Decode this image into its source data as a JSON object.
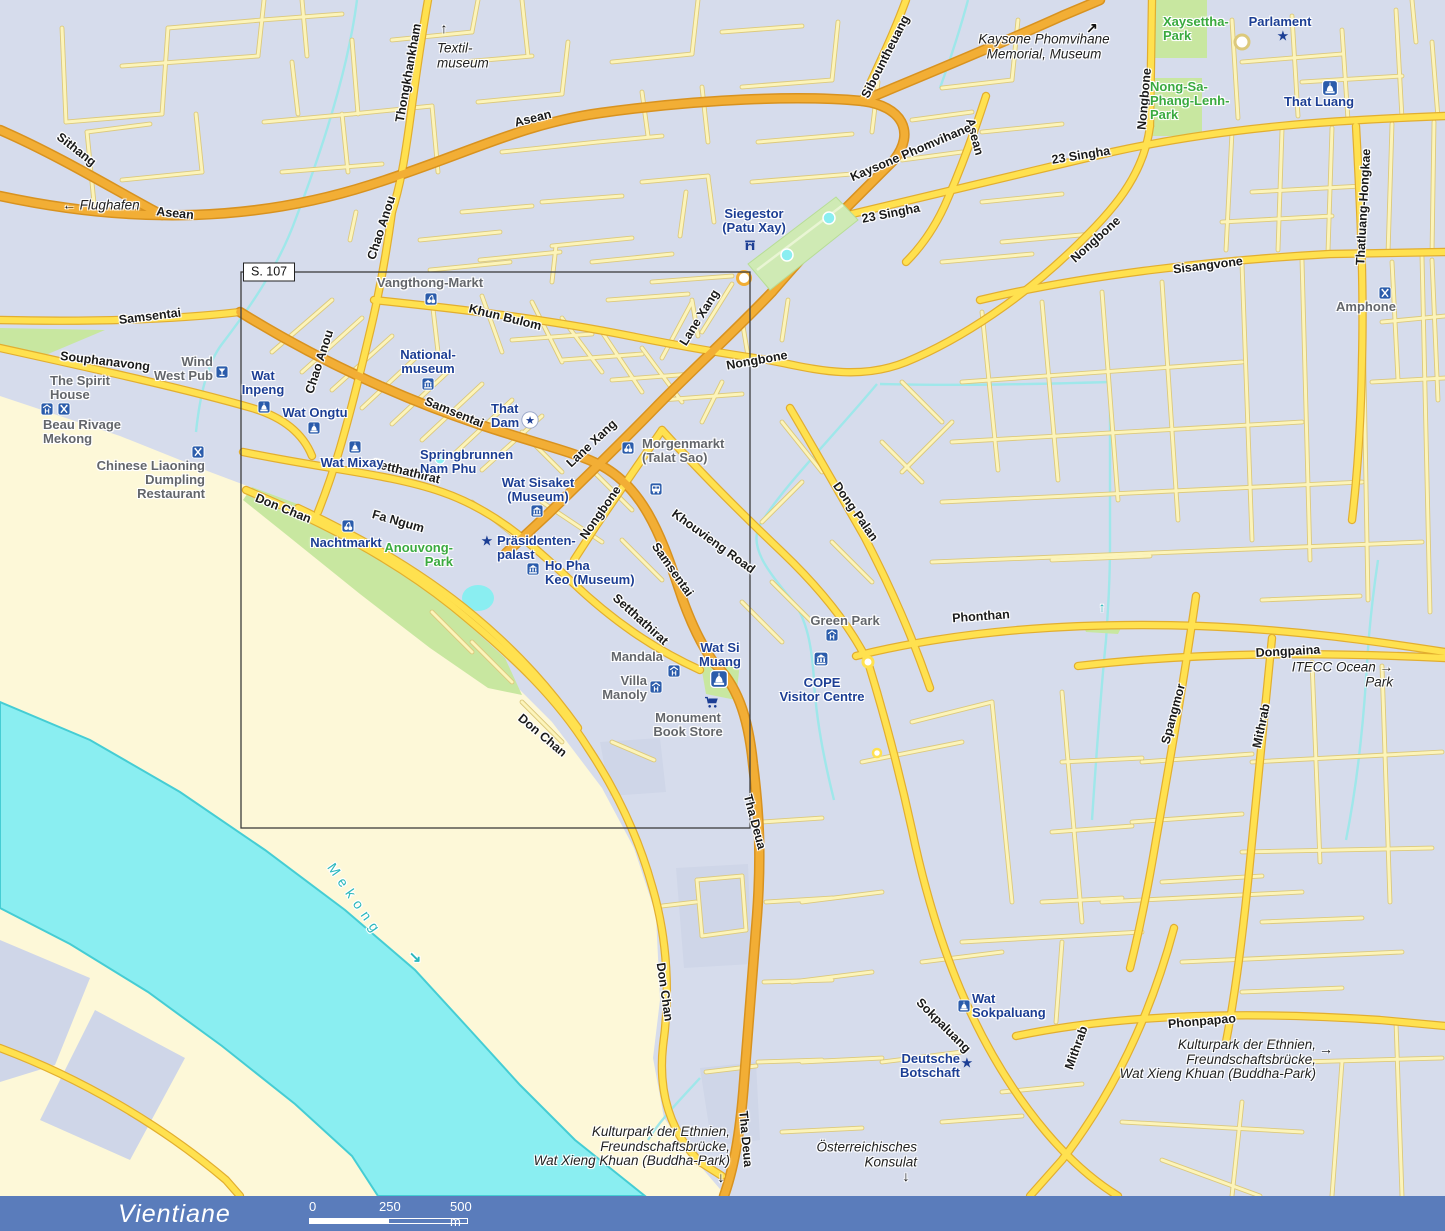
{
  "colors": {
    "background": "#d6dcec",
    "land": "#fdf8d8",
    "river": "#8aeef1",
    "river_edge": "#45cdd4",
    "park": "#c8e7a0",
    "road_minor": "#fcf4ba",
    "road_main": "#ffe14f",
    "road_highway": "#f2ae35",
    "poi_text": "#1c3e94",
    "poi_gray": "#63666b",
    "park_text": "#3aaa3f",
    "water_text": "#29b7bc",
    "icon_blue": "#2b5cab",
    "footer_bar": "#5a7cbb"
  },
  "map": {
    "region_label": "S. 107",
    "labels": [
      {
        "t": "Sithang",
        "x": 76,
        "y": 150,
        "r": 38,
        "s": "road"
      },
      {
        "t": "Asean",
        "x": 175,
        "y": 214,
        "r": 6,
        "s": "road"
      },
      {
        "t": "Asean",
        "x": 533,
        "y": 119,
        "r": -14,
        "s": "road"
      },
      {
        "t": "Asean",
        "x": 974,
        "y": 137,
        "r": 75,
        "s": "road"
      },
      {
        "t": "Thongkhankham",
        "x": 409,
        "y": 73,
        "r": -80,
        "s": "road"
      },
      {
        "t": "Chao Anou",
        "x": 382,
        "y": 228,
        "r": -72,
        "s": "road"
      },
      {
        "t": "Chao Anou",
        "x": 320,
        "y": 362,
        "r": -72,
        "s": "road"
      },
      {
        "t": "Sibountheuang",
        "x": 886,
        "y": 57,
        "r": -63,
        "s": "road"
      },
      {
        "t": "Kaysone Phomvihane",
        "x": 911,
        "y": 153,
        "r": -23,
        "s": "road"
      },
      {
        "t": "23 Singha",
        "x": 891,
        "y": 214,
        "r": -11,
        "s": "road"
      },
      {
        "t": "23 Singha",
        "x": 1081,
        "y": 156,
        "r": -9,
        "s": "road"
      },
      {
        "t": "Nongbone",
        "x": 1145,
        "y": 99,
        "r": -85,
        "s": "road"
      },
      {
        "t": "Nongbone",
        "x": 1096,
        "y": 240,
        "r": -42,
        "s": "road"
      },
      {
        "t": "Nongbone",
        "x": 757,
        "y": 361,
        "r": -10,
        "s": "road"
      },
      {
        "t": "Nongbone",
        "x": 601,
        "y": 513,
        "r": -55,
        "s": "road"
      },
      {
        "t": "Sisangvone",
        "x": 1208,
        "y": 266,
        "r": -7,
        "s": "road"
      },
      {
        "t": "Thatluang-Hongkae",
        "x": 1364,
        "y": 207,
        "r": -87,
        "s": "road"
      },
      {
        "t": "Samsentai",
        "x": 150,
        "y": 317,
        "r": -7,
        "s": "road"
      },
      {
        "t": "Samsentai",
        "x": 454,
        "y": 413,
        "r": 22,
        "s": "road"
      },
      {
        "t": "Samsentai",
        "x": 672,
        "y": 570,
        "r": 55,
        "s": "road"
      },
      {
        "t": "Souphanavong",
        "x": 105,
        "y": 362,
        "r": 7,
        "s": "road"
      },
      {
        "t": "Khun Bulom",
        "x": 505,
        "y": 318,
        "r": 14,
        "s": "road"
      },
      {
        "t": "Lane Xang",
        "x": 700,
        "y": 318,
        "r": -58,
        "s": "road"
      },
      {
        "t": "Lane Xang",
        "x": 592,
        "y": 444,
        "r": -43,
        "s": "road"
      },
      {
        "t": "Setthathirat",
        "x": 406,
        "y": 472,
        "r": 14,
        "s": "road"
      },
      {
        "t": "Setthathirat",
        "x": 640,
        "y": 620,
        "r": 42,
        "s": "road"
      },
      {
        "t": "Khouvieng Road",
        "x": 713,
        "y": 542,
        "r": 36,
        "s": "road"
      },
      {
        "t": "Fa Ngum",
        "x": 398,
        "y": 522,
        "r": 16,
        "s": "road"
      },
      {
        "t": "Don Chan",
        "x": 283,
        "y": 509,
        "r": 22,
        "s": "road"
      },
      {
        "t": "Don Chan",
        "x": 542,
        "y": 736,
        "r": 40,
        "s": "road"
      },
      {
        "t": "Don Chan",
        "x": 664,
        "y": 992,
        "r": 82,
        "s": "road"
      },
      {
        "t": "Tha Deua",
        "x": 754,
        "y": 822,
        "r": 75,
        "s": "road"
      },
      {
        "t": "Tha Deua",
        "x": 745,
        "y": 1139,
        "r": 85,
        "s": "road"
      },
      {
        "t": "Dong Palan",
        "x": 855,
        "y": 512,
        "r": 55,
        "s": "road"
      },
      {
        "t": "Phonthan",
        "x": 981,
        "y": 617,
        "r": -4,
        "s": "road"
      },
      {
        "t": "Dongpaina",
        "x": 1288,
        "y": 652,
        "r": -3,
        "s": "road"
      },
      {
        "t": "Spangmor",
        "x": 1174,
        "y": 714,
        "r": -75,
        "s": "road"
      },
      {
        "t": "Mithrab",
        "x": 1262,
        "y": 726,
        "r": -78,
        "s": "road"
      },
      {
        "t": "Mithrab",
        "x": 1077,
        "y": 1048,
        "r": -70,
        "s": "road"
      },
      {
        "t": "Sokpaluang",
        "x": 943,
        "y": 1026,
        "r": 45,
        "s": "road"
      },
      {
        "t": "Phonpapao",
        "x": 1202,
        "y": 1022,
        "r": -5,
        "s": "road"
      },
      {
        "t": "Siegestor\n(Patu Xay)",
        "x": 754,
        "y": 221,
        "s": "poi"
      },
      {
        "t": "Parlament",
        "x": 1280,
        "y": 22,
        "s": "poi"
      },
      {
        "t": "That Luang",
        "x": 1319,
        "y": 102,
        "s": "poi"
      },
      {
        "t": "Wat\nInpeng",
        "x": 263,
        "y": 383,
        "s": "poi"
      },
      {
        "t": "Wat Ongtu",
        "x": 315,
        "y": 413,
        "s": "poi"
      },
      {
        "t": "Wat Mixay",
        "x": 352,
        "y": 463,
        "s": "poi"
      },
      {
        "t": "National-\nmuseum",
        "x": 428,
        "y": 362,
        "s": "poi"
      },
      {
        "t": "That\nDam",
        "x": 491,
        "y": 416,
        "a": "l",
        "s": "poi"
      },
      {
        "t": "Springbrunnen\nNam Phu",
        "x": 420,
        "y": 462,
        "a": "l",
        "s": "poi"
      },
      {
        "t": "Wat Sisaket\n(Museum)",
        "x": 538,
        "y": 490,
        "s": "poi"
      },
      {
        "t": "Präsidenten-\npalast",
        "x": 497,
        "y": 548,
        "a": "l",
        "s": "poi"
      },
      {
        "t": "Ho Pha\nKeo (Museum)",
        "x": 545,
        "y": 573,
        "a": "l",
        "s": "poi"
      },
      {
        "t": "Wat Si\nMuang",
        "x": 720,
        "y": 655,
        "s": "poi"
      },
      {
        "t": "COPE\nVisitor Centre",
        "x": 822,
        "y": 690,
        "s": "poi"
      },
      {
        "t": "Wat\nSokpaluang",
        "x": 972,
        "y": 1006,
        "a": "l",
        "s": "poi"
      },
      {
        "t": "Deutsche\nBotschaft",
        "x": 960,
        "y": 1066,
        "a": "r",
        "s": "poi"
      },
      {
        "t": "Nachtmarkt",
        "x": 346,
        "y": 543,
        "s": "poi"
      },
      {
        "t": "Wind\nWest Pub",
        "x": 213,
        "y": 369,
        "a": "r",
        "s": "gray"
      },
      {
        "t": "Vangthong-Markt",
        "x": 430,
        "y": 283,
        "s": "gray"
      },
      {
        "t": "Morgenmarkt\n(Talat Sao)",
        "x": 642,
        "y": 451,
        "a": "l",
        "s": "gray"
      },
      {
        "t": "The Spirit\nHouse",
        "x": 50,
        "y": 388,
        "a": "l",
        "s": "gray"
      },
      {
        "t": "Beau Rivage\nMekong",
        "x": 43,
        "y": 432,
        "a": "l",
        "s": "gray"
      },
      {
        "t": "Chinese Liaoning\nDumpling\nRestaurant",
        "x": 205,
        "y": 480,
        "a": "r",
        "s": "gray"
      },
      {
        "t": "Green Park",
        "x": 845,
        "y": 621,
        "s": "gray"
      },
      {
        "t": "Mandala",
        "x": 637,
        "y": 657,
        "s": "gray"
      },
      {
        "t": "Villa\nManoly",
        "x": 647,
        "y": 688,
        "a": "r",
        "s": "gray"
      },
      {
        "t": "Monument\nBook Store",
        "x": 688,
        "y": 725,
        "s": "gray"
      },
      {
        "t": "Amphone",
        "x": 1366,
        "y": 307,
        "s": "gray"
      },
      {
        "t": "← Flughafen",
        "x": 101,
        "y": 206,
        "s": "it"
      },
      {
        "t": "Textil-\nmuseum",
        "x": 437,
        "y": 56,
        "a": "l",
        "s": "it"
      },
      {
        "t": "Kaysone Phomvihane\nMemorial, Museum",
        "x": 1044,
        "y": 47,
        "s": "it"
      },
      {
        "t": "ITECC Ocean →\nPark",
        "x": 1393,
        "y": 675,
        "a": "r",
        "s": "it"
      },
      {
        "t": "Kulturpark der Ethnien,\nFreundschaftsbrücke,\nWat Xieng Khuan (Buddha-Park)",
        "x": 1316,
        "y": 1060,
        "a": "r",
        "s": "it"
      },
      {
        "t": "Kulturpark der Ethnien,\nFreundschaftsbrücke,\nWat Xieng Khuan (Buddha-Park)",
        "x": 730,
        "y": 1147,
        "a": "r",
        "s": "it"
      },
      {
        "t": "Österreichisches\nKonsulat",
        "x": 917,
        "y": 1155,
        "a": "r",
        "s": "it"
      },
      {
        "t": "Xaysettha-\nPark",
        "x": 1163,
        "y": 29,
        "a": "l",
        "s": "park"
      },
      {
        "t": "Nong-Sa-\nPhang-Lenh-\nPark",
        "x": 1150,
        "y": 101,
        "a": "l",
        "s": "park"
      },
      {
        "t": "Anouvong-\nPark",
        "x": 453,
        "y": 555,
        "a": "r",
        "s": "park"
      },
      {
        "t": "Mekong",
        "x": 355,
        "y": 900,
        "r": 55,
        "s": "water"
      }
    ],
    "icons": [
      {
        "k": "market",
        "x": 431,
        "y": 299
      },
      {
        "k": "market",
        "x": 628,
        "y": 448
      },
      {
        "k": "market",
        "x": 348,
        "y": 526
      },
      {
        "k": "bus",
        "x": 656,
        "y": 489
      },
      {
        "k": "wat",
        "x": 264,
        "y": 407
      },
      {
        "k": "wat",
        "x": 314,
        "y": 428
      },
      {
        "k": "wat",
        "x": 355,
        "y": 447
      },
      {
        "k": "wat",
        "x": 719,
        "y": 679,
        "sz": 18
      },
      {
        "k": "wat",
        "x": 964,
        "y": 1006
      },
      {
        "k": "wat",
        "x": 1330,
        "y": 88,
        "sz": 16
      },
      {
        "k": "museum",
        "x": 428,
        "y": 384
      },
      {
        "k": "museum",
        "x": 537,
        "y": 511
      },
      {
        "k": "museum",
        "x": 533,
        "y": 569
      },
      {
        "k": "museum",
        "x": 821,
        "y": 659,
        "sz": 15
      },
      {
        "k": "hotel",
        "x": 47,
        "y": 409
      },
      {
        "k": "hotel",
        "x": 674,
        "y": 671
      },
      {
        "k": "hotel",
        "x": 656,
        "y": 687
      },
      {
        "k": "hotel",
        "x": 832,
        "y": 635
      },
      {
        "k": "rest",
        "x": 64,
        "y": 409
      },
      {
        "k": "rest",
        "x": 198,
        "y": 452
      },
      {
        "k": "rest",
        "x": 1385,
        "y": 293
      },
      {
        "k": "bar",
        "x": 222,
        "y": 372
      },
      {
        "k": "cart",
        "x": 712,
        "y": 702
      },
      {
        "k": "gate",
        "x": 750,
        "y": 245
      },
      {
        "k": "star",
        "x": 1283,
        "y": 36
      },
      {
        "k": "star",
        "x": 487,
        "y": 541
      },
      {
        "k": "star",
        "x": 967,
        "y": 1063
      },
      {
        "k": "starc",
        "x": 530,
        "y": 420
      },
      {
        "k": "arr",
        "ch": "↑",
        "x": 444,
        "y": 28,
        "c": "#111",
        "sz": 14
      },
      {
        "k": "arr",
        "ch": "↗",
        "x": 1092,
        "y": 28,
        "c": "#111",
        "sz": 14
      },
      {
        "k": "arr",
        "ch": "→",
        "x": 1326,
        "y": 1049,
        "c": "#111",
        "sz": 14
      },
      {
        "k": "arr",
        "ch": "↓",
        "x": 721,
        "y": 1177,
        "c": "#111",
        "sz": 14
      },
      {
        "k": "arr",
        "ch": "↓",
        "x": 906,
        "y": 1176,
        "c": "#111",
        "sz": 14
      },
      {
        "k": "arr",
        "ch": "↘",
        "x": 415,
        "y": 957,
        "c": "#29b7bc",
        "sz": 15
      },
      {
        "k": "arr",
        "ch": "↑",
        "x": 1102,
        "y": 607,
        "c": "#29b7bc",
        "sz": 13
      }
    ]
  },
  "footer": {
    "title": "Vientiane",
    "scale": {
      "start": "0",
      "mid": "250",
      "end": "500 m"
    }
  }
}
